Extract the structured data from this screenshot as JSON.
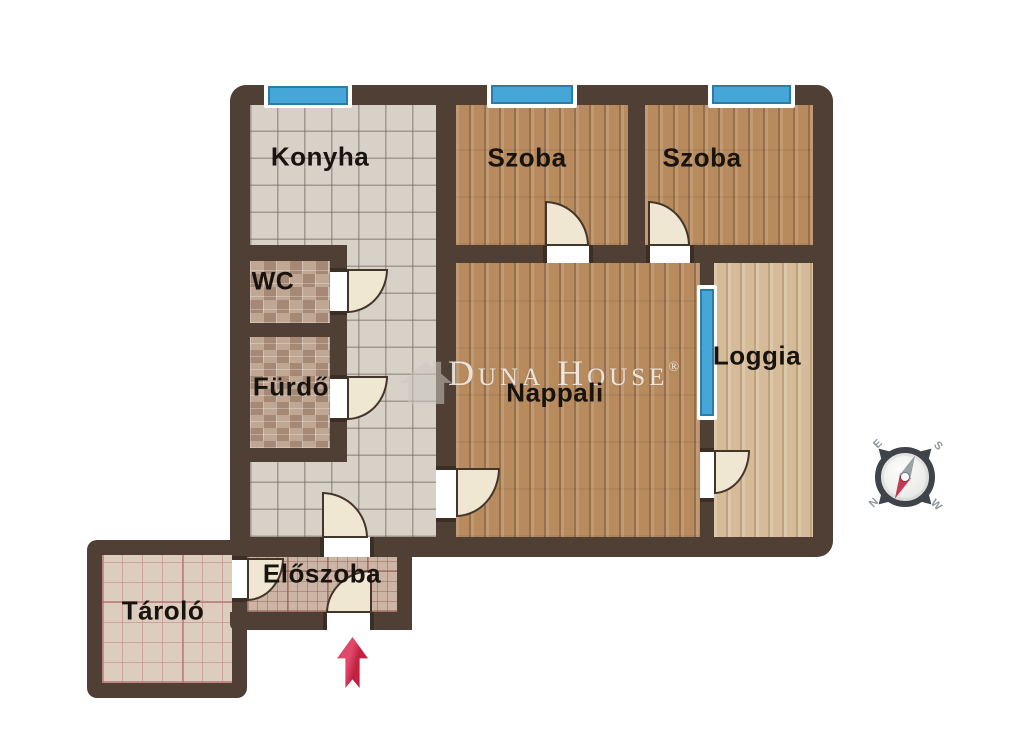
{
  "app": {
    "type": "apartment-floor-plan",
    "watermark": "Duna House",
    "registered_mark": "®"
  },
  "rooms": {
    "konyha": {
      "label": "Konyha"
    },
    "szoba_1": {
      "label": "Szoba"
    },
    "szoba_2": {
      "label": "Szoba"
    },
    "wc": {
      "label": "WC"
    },
    "furdo": {
      "label": "Fürdő"
    },
    "nappali": {
      "label": "Nappali"
    },
    "loggia": {
      "label": "Loggia"
    },
    "eloszoba": {
      "label": "Előszoba"
    },
    "tarolo": {
      "label": "Tároló"
    }
  },
  "compass": {
    "north": "N",
    "south": "S",
    "east": "E",
    "west": "W"
  },
  "colors": {
    "wall": "#4f3f35",
    "window_blue": "#47a6d8",
    "door_fill": "#f0e7d3",
    "arrow_red": "#d12b4b",
    "needle_red": "#c23a55",
    "needle_gray": "#99a1a7",
    "floor_tile": "#d8d1c7",
    "floor_wood": "#b88b5e",
    "floor_loggia": "#d6bb98"
  }
}
